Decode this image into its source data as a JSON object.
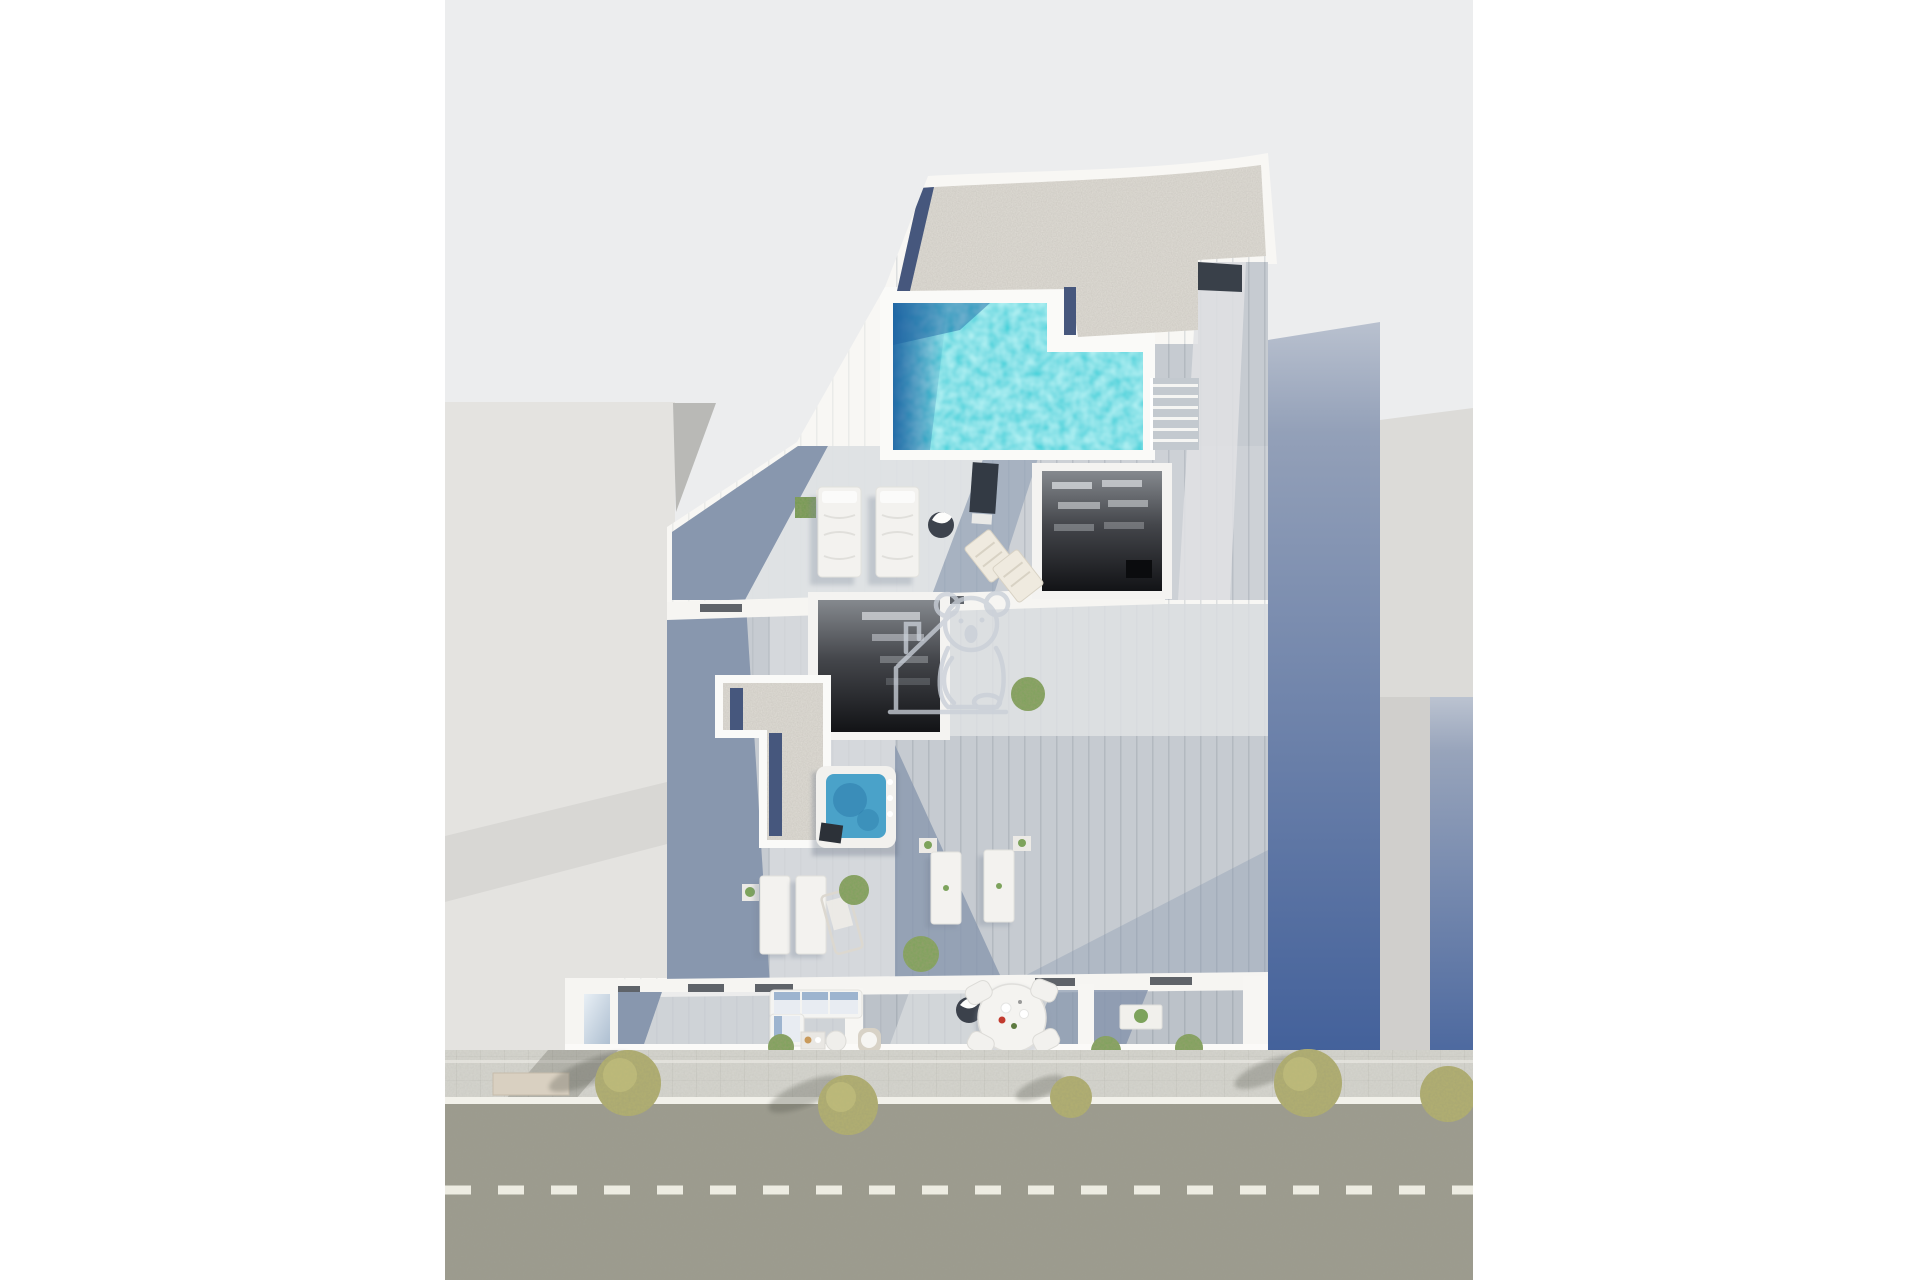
{
  "scene": {
    "title": "Aerial 3D render - rooftop floor plan with swimming pool, terraces and street",
    "type": "architectural-3d-render",
    "view": "top-down aerial",
    "canvas": {
      "width": 1920,
      "height": 1280
    }
  },
  "colors": {
    "margin": "#ffffff",
    "background": "#ecedee",
    "building_white": "#f8f7f4",
    "neighbor_left": "#e4e3e0",
    "neighbor_right_roof": "#dcdbd8",
    "neighbor_right_lower": "#d0cfcc",
    "gravel": "#e0ddd6",
    "navy_strip": "#46577d",
    "pool_water": "#25ced8",
    "pool_deep": "#1a5fa0",
    "deck_wood": "#cdd1d6",
    "deck_sun": "#e1e3e5",
    "deck_shade": "#8897ae",
    "lower_wood": "#c6cbd1",
    "balcony_wood": "#bcc2c9",
    "hot_tub_water": "#4aa2c9",
    "skylight_dark": "#17181c",
    "road": "#9c9b8e",
    "sidewalk": "#d6d5cf",
    "curb_line": "#f2f1ea",
    "lane_marking": "#edece2",
    "tree_foliage": "#b3b071",
    "plant_green": "#7da35c",
    "furniture_white": "#f3f2ef",
    "watermark": "#c9cfd8",
    "door_dark": "#394049"
  },
  "street": {
    "lane_marking_style": "dashed",
    "dash_length_px": 26,
    "dash_gap_px": 27
  },
  "elements": {
    "watermark": "koala-with-house logo watermark",
    "pool": "L-shaped rooftop swimming pool",
    "hot_tub": "square hot tub",
    "skylights": 2,
    "sun_beds": 2,
    "beach_chairs": 2,
    "terrace_loungers": 4,
    "balcony_sofa": 1,
    "dining_chairs": 4,
    "round_dining_table": 1,
    "street_trees": 5,
    "neighbor_buildings": 2
  }
}
